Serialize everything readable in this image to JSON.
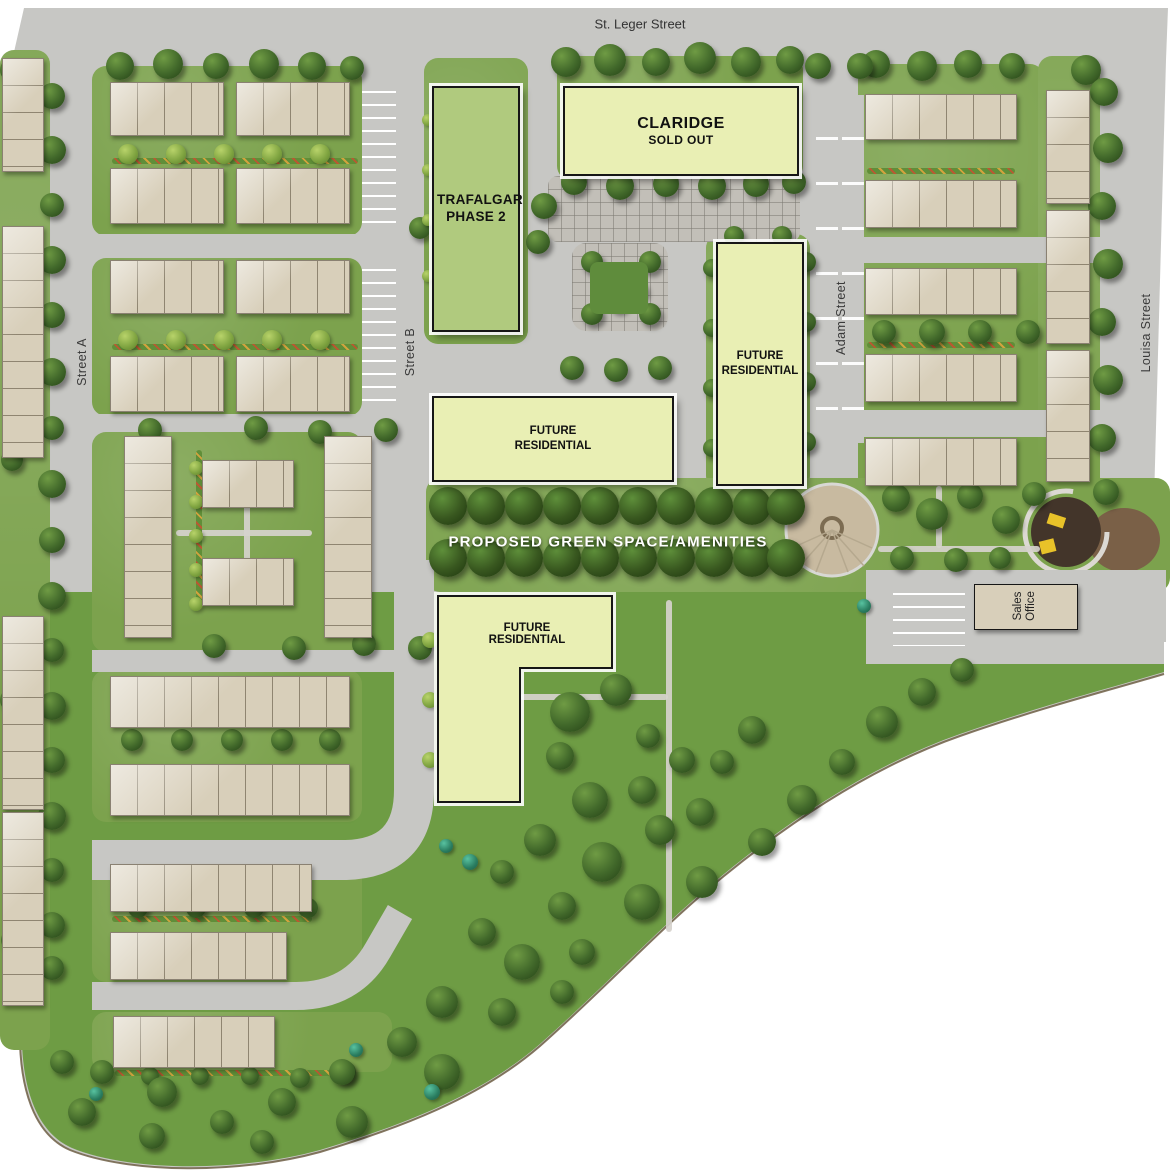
{
  "map": {
    "streets": {
      "st_leger": "St. Leger Street",
      "street_a": "Street A",
      "street_b": "Street B",
      "adam": "Adam Street",
      "louisa": "Louisa Street"
    },
    "buildings": {
      "trafalgar_label": "TRAFALGAR PHASE 2",
      "claridge_name": "CLARIDGE",
      "claridge_status": "SOLD OUT",
      "future_residential": "FUTURE RESIDENTIAL",
      "sales_office": "Sales Office"
    },
    "annotations": {
      "green_space": "PROPOSED GREEN SPACE/AMENITIES"
    },
    "colors": {
      "road": "#c7c7c4",
      "lawn": "#7ca24d",
      "lawn_deep": "#6e9c44",
      "townhouse": "#d8cfba",
      "trafalgar_fill": "#b0ca7e",
      "future_fill": "#e9efb4",
      "plaza": "#c8baa0",
      "mulch": "#7a6047",
      "playground": "#43352a",
      "play_equipment": "#e8c229",
      "label_text": "#222222"
    }
  }
}
